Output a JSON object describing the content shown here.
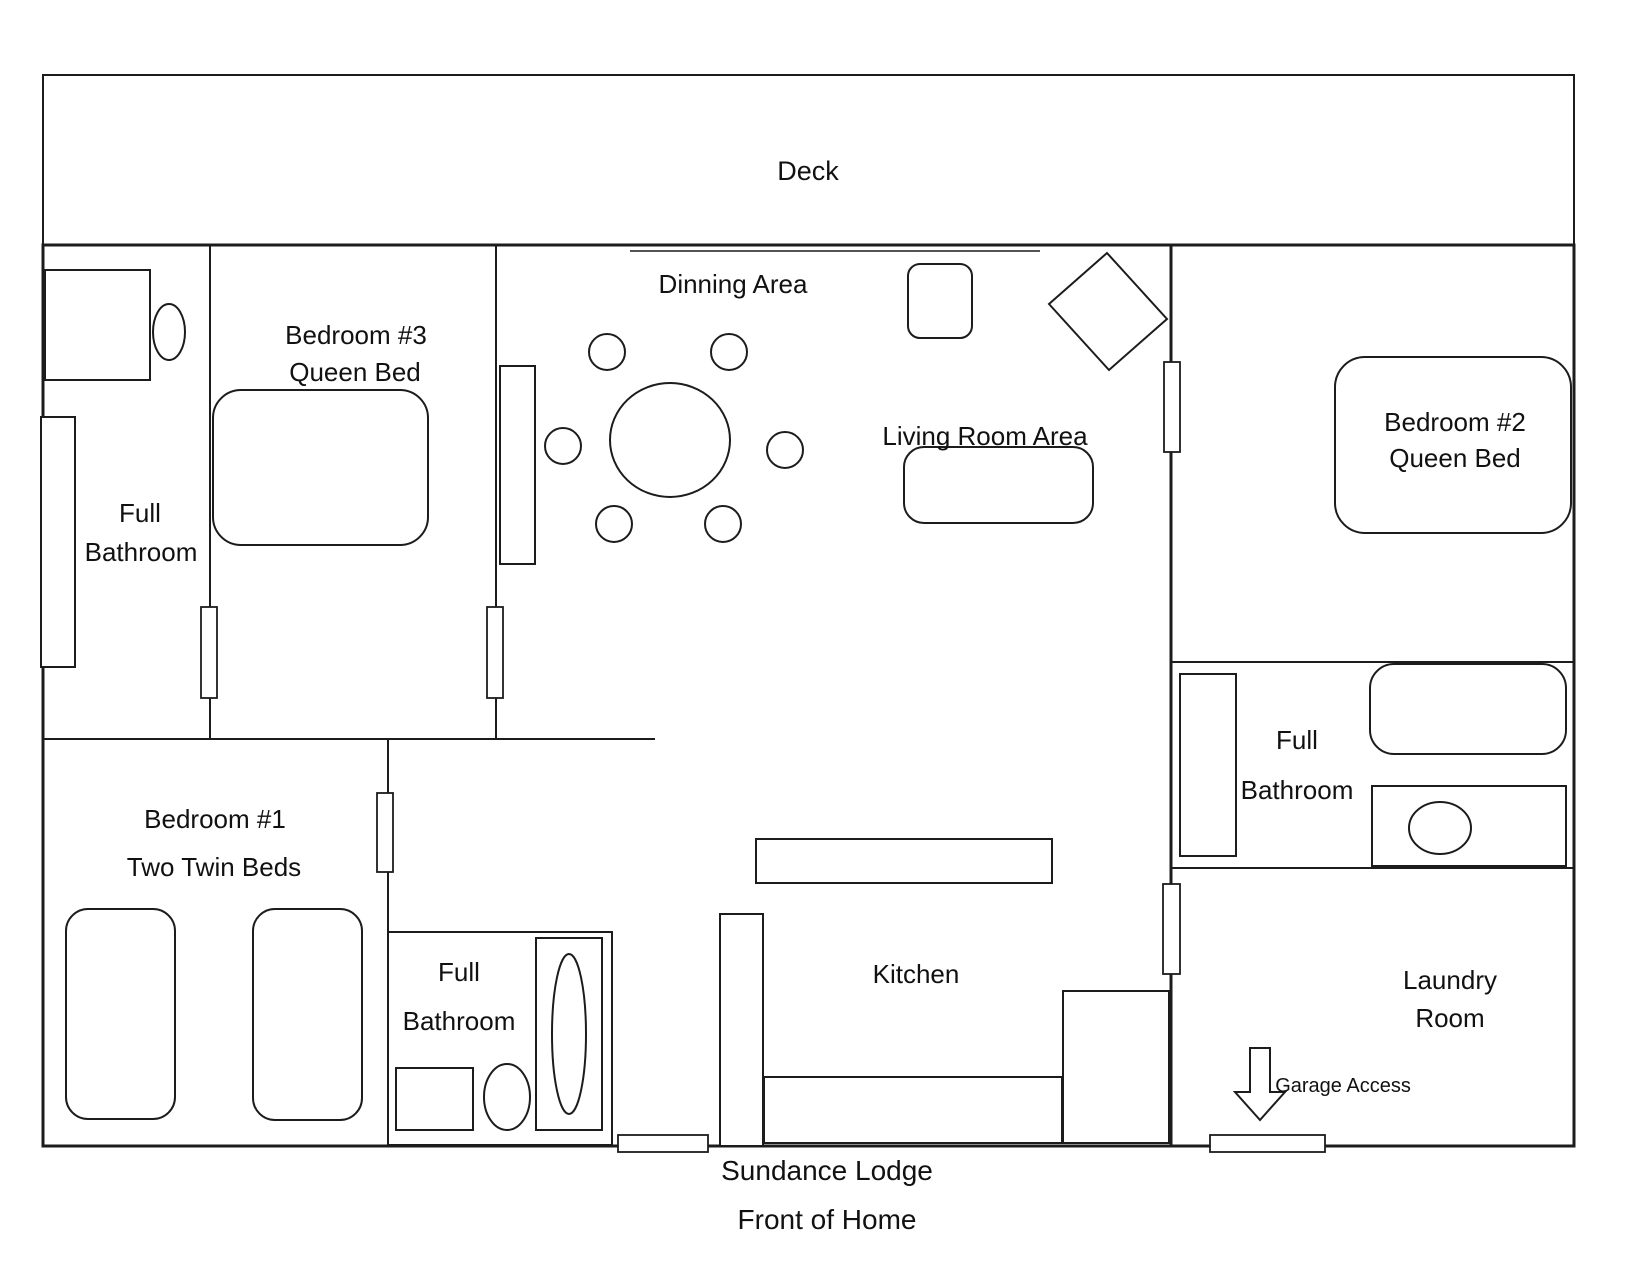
{
  "plan_title": "Sundance Lodge",
  "rooms": {
    "deck": {
      "label": "Deck"
    },
    "dining": {
      "label": "Dinning Area"
    },
    "living": {
      "label": "Living Room Area"
    },
    "kitchen": {
      "label": "Kitchen"
    },
    "bedroom1": {
      "lines": [
        "Bedroom #1",
        "Two Twin Beds"
      ]
    },
    "bedroom2": {
      "lines": [
        "Bedroom #2",
        "Queen Bed"
      ]
    },
    "bedroom3": {
      "lines": [
        "Bedroom #3",
        "Queen Bed"
      ]
    },
    "bath_left": {
      "lines": [
        "Full",
        "Bathroom"
      ]
    },
    "bath_middle": {
      "lines": [
        "Full",
        "Bathroom"
      ]
    },
    "bath_right": {
      "lines": [
        "Full",
        "Bathroom"
      ]
    },
    "laundry": {
      "lines": [
        "Laundry",
        "Room"
      ]
    }
  },
  "annotations": {
    "garage_access": "Garage Access",
    "footer": [
      "Sundance Lodge",
      "Front of Home"
    ]
  },
  "colors": {
    "wall": "#1c1c1c",
    "background": "#ffffff",
    "text": "#111111"
  }
}
